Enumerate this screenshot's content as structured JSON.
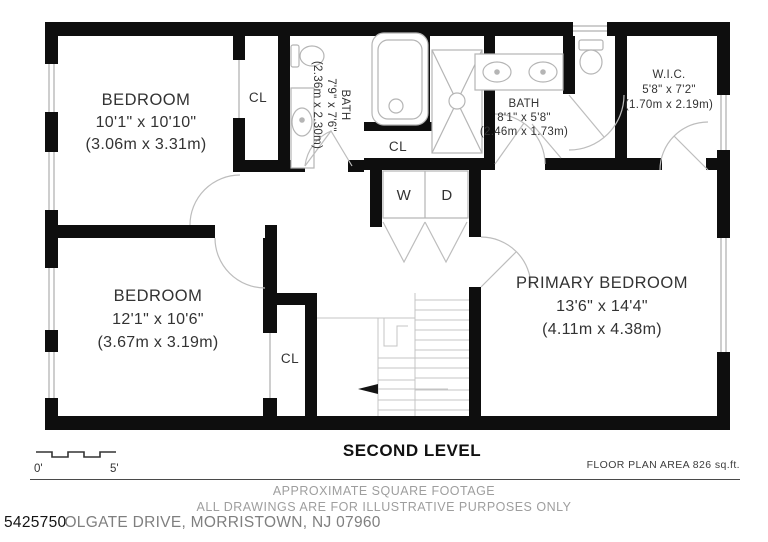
{
  "title": {
    "level": "SECOND LEVEL"
  },
  "rooms": {
    "bedroom1": {
      "name": "BEDROOM",
      "dims": "10'1\" x 10'10\"",
      "metric": "(3.06m x 3.31m)"
    },
    "bedroom2": {
      "name": "BEDROOM",
      "dims": "12'1\" x 10'6\"",
      "metric": "(3.67m x 3.19m)"
    },
    "primary_bedroom": {
      "name": "PRIMARY BEDROOM",
      "dims": "13'6\" x 14'4\"",
      "metric": "(4.11m x 4.38m)"
    },
    "bath_hall": {
      "name": "BATH",
      "dims": "7'9\" x 7'6\"",
      "metric": "(2.36m x 2.30m)"
    },
    "bath_primary": {
      "name": "BATH",
      "dims": "8'1\" x 5'8\"",
      "metric": "(2.46m x 1.73m)"
    },
    "wic": {
      "name": "W.I.C.",
      "dims": "5'8\" x 7'2\"",
      "metric": "(1.70m x 2.19m)"
    },
    "closet_bedroom1": {
      "name": "CL"
    },
    "closet_hall": {
      "name": "CL"
    },
    "closet_bedroom2": {
      "name": "CL"
    },
    "washer": {
      "name": "W"
    },
    "dryer": {
      "name": "D"
    }
  },
  "scale_bar": {
    "start_label": "0'",
    "end_label": "5'"
  },
  "footer": {
    "floor_area": "FLOOR PLAN AREA 826 sq.ft.",
    "disclaimer_line1": "APPROXIMATE SQUARE FOOTAGE",
    "disclaimer_line2": "ALL DRAWINGS ARE FOR ILLUSTRATIVE PURPOSES ONLY",
    "listing_number": "5425750",
    "address_fragment": "OLGATE DRIVE, MORRISTOWN, NJ 07960"
  },
  "colors": {
    "wall": "#0e0e0e",
    "fixture_line": "#b5b5b5",
    "door_line": "#bdbdbd",
    "label_text": "#333333",
    "muted_text": "#9e9e9e"
  }
}
